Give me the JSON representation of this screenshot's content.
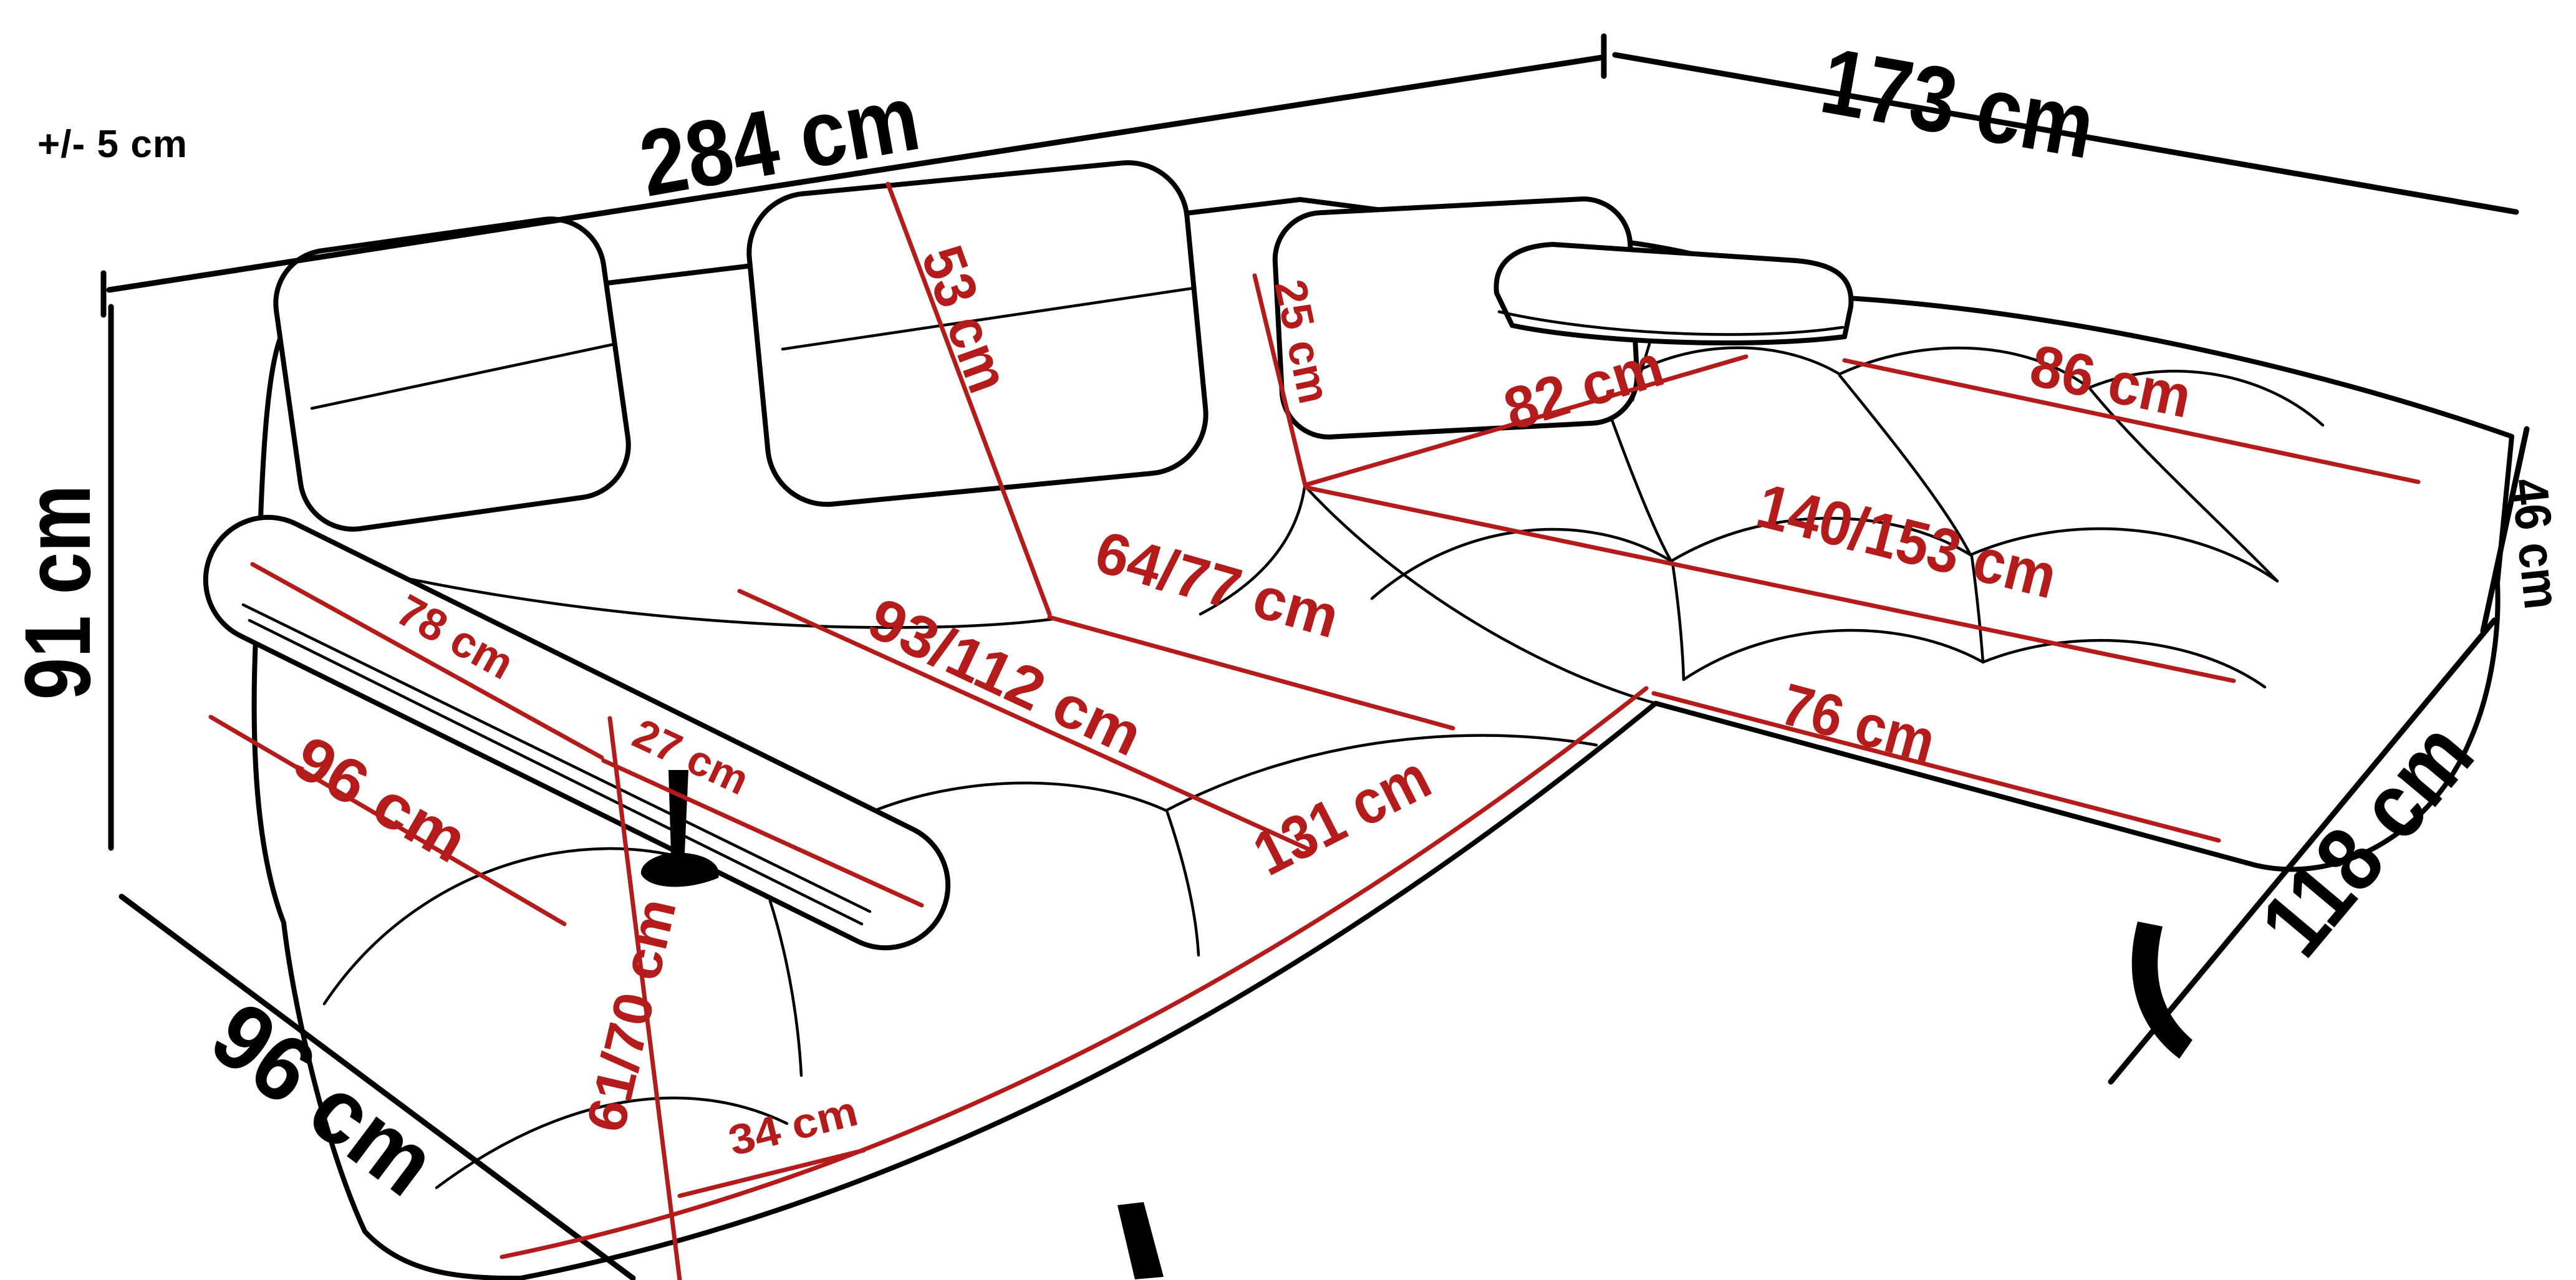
{
  "diagram": {
    "subject": "corner-sofa-dimension-diagram",
    "unit": "cm",
    "colors": {
      "outline": "#000000",
      "detail_dimension": "#b41c1c",
      "background": "#ffffff"
    },
    "tolerance": {
      "label": "+/- 5 cm"
    },
    "overall": [
      {
        "name": "total-width",
        "label": "284 cm",
        "value_cm": 284
      },
      {
        "name": "chaise-side-width",
        "label": "173 cm",
        "value_cm": 173
      },
      {
        "name": "back-height",
        "label": "91 cm",
        "value_cm": 91
      },
      {
        "name": "left-side-depth",
        "label": "96 cm",
        "value_cm": 96
      },
      {
        "name": "right-seat-height",
        "label": "46 cm",
        "value_cm": 46
      },
      {
        "name": "chaise-total-depth",
        "label": "118 cm",
        "value_cm": 118
      }
    ],
    "details": [
      {
        "name": "backrest-cushion-height",
        "label": "53 cm",
        "value_cm": 53
      },
      {
        "name": "headrest-section-height",
        "label": "25 cm",
        "value_cm": 25
      },
      {
        "name": "corner-back-width",
        "label": "82 cm",
        "value_cm": 82
      },
      {
        "name": "chaise-back-width",
        "label": "86 cm",
        "value_cm": 86
      },
      {
        "name": "chaise-seat-length",
        "label": "140/153 cm",
        "value_cm": [
          140,
          153
        ]
      },
      {
        "name": "seat-depth-right",
        "label": "64/77 cm",
        "value_cm": [
          64,
          77
        ]
      },
      {
        "name": "seat-depth-left",
        "label": "93/112 cm",
        "value_cm": [
          93,
          112
        ]
      },
      {
        "name": "armrest-pad-length",
        "label": "78 cm",
        "value_cm": 78
      },
      {
        "name": "armrest-front-length",
        "label": "27 cm",
        "value_cm": 27
      },
      {
        "name": "seat-side-depth",
        "label": "96 cm",
        "value_cm": 96
      },
      {
        "name": "front-edge-length",
        "label": "131 cm",
        "value_cm": 131
      },
      {
        "name": "chaise-front-width",
        "label": "76 cm",
        "value_cm": 76
      },
      {
        "name": "front-seat-height",
        "label": "61/70 cm",
        "value_cm": [
          61,
          70
        ]
      },
      {
        "name": "leg-base-length",
        "label": "34 cm",
        "value_cm": 34
      }
    ]
  }
}
